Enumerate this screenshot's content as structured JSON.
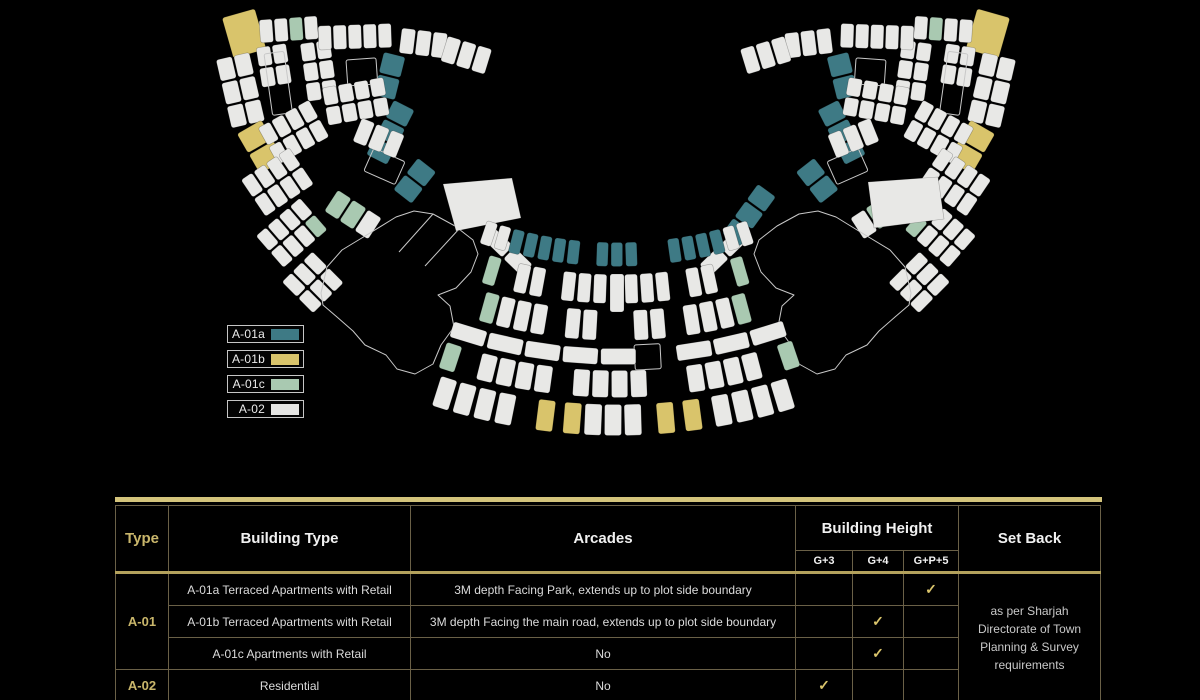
{
  "plan": {
    "background": "#000000",
    "colors": {
      "teal": "#3E7A85",
      "gold": "#D9C46B",
      "green": "#A9C9B1",
      "white": "#E8E8E6",
      "outline": "#C8C8C8"
    },
    "legend": [
      {
        "label": "A-01a",
        "color": "#3E7A85"
      },
      {
        "label": "A-01b",
        "color": "#D9C46B"
      },
      {
        "label": "A-01c",
        "color": "#A9C9B1"
      },
      {
        "label": "A-02",
        "color": "#E4E4E2"
      }
    ]
  },
  "table": {
    "accent_color": "#D4C47C",
    "headers": {
      "type": "Type",
      "building_type": "Building Type",
      "arcades": "Arcades",
      "building_height": "Building Height",
      "set_back": "Set Back",
      "sub": [
        "G+3",
        "G+4",
        "G+P+5"
      ]
    },
    "groups": [
      {
        "type": "A-01",
        "rows": [
          {
            "building_type": "A-01a Terraced Apartments with Retail",
            "arcades": "3M depth Facing Park, extends up to plot side boundary",
            "g3": "",
            "g4": "",
            "gp5": "✓"
          },
          {
            "building_type": "A-01b Terraced Apartments with Retail",
            "arcades": "3M depth Facing the main road, extends up to plot side boundary",
            "g3": "",
            "g4": "✓",
            "gp5": ""
          },
          {
            "building_type": "A-01c Apartments with Retail",
            "arcades": "No",
            "g3": "",
            "g4": "✓",
            "gp5": ""
          }
        ]
      },
      {
        "type": "A-02",
        "rows": [
          {
            "building_type": "Residential",
            "arcades": "No",
            "g3": "✓",
            "g4": "",
            "gp5": ""
          }
        ]
      }
    ],
    "set_back": "as per Sharjah Directorate of Town Planning & Survey requirements"
  }
}
